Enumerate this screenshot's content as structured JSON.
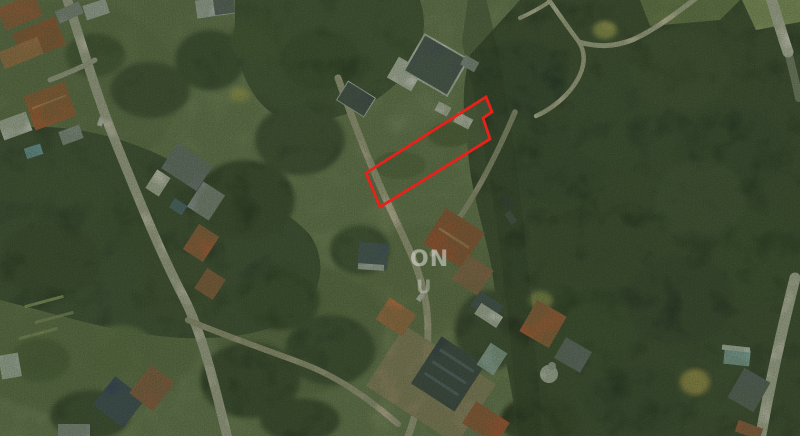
{
  "page": {
    "type": "aerial-satellite-photo",
    "width": 800,
    "height": 436
  },
  "watermark": {
    "line1": "ON",
    "line2": "U",
    "color": "#ffffff"
  },
  "parcel_annotation": {
    "shape": "polygon",
    "points": "366,173 486,97 492,112 483,118 490,139 380,207",
    "color": "#e8221a",
    "stroke_width": "2.8"
  },
  "palette": {
    "ground_olive": "#6f7f55",
    "forest_dark": "#2c3a24",
    "forest_mid": "#31402a",
    "forest_north": "#36462b",
    "road_light": "#cfc9b8",
    "road_tan": "#c4b99f",
    "dirt_lot": "#a28c6d",
    "roof_red": "#ab4e2d",
    "roof_orange": "#ad5a32",
    "roof_navy": "#2e3644",
    "grass_light": "#9cab6d"
  }
}
